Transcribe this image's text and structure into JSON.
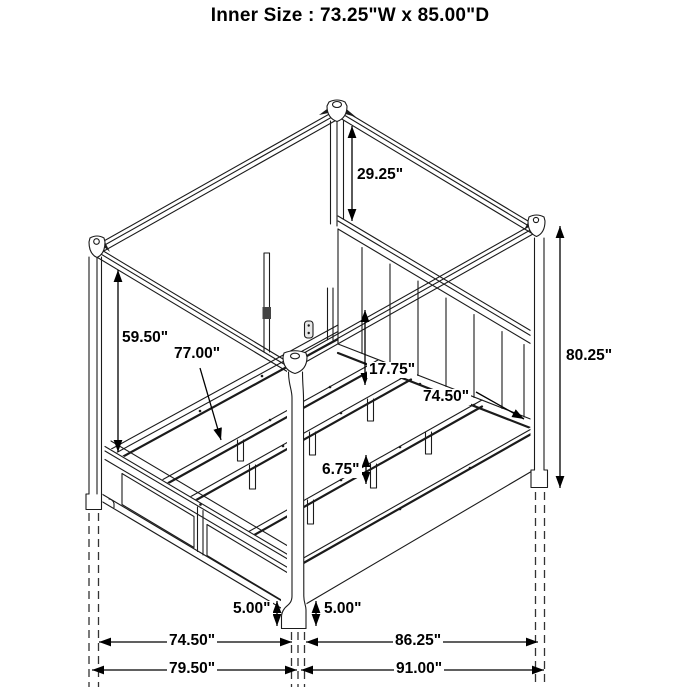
{
  "title": "Inner Size : 73.25\"W x 85.00\"D",
  "diagram": {
    "subject": "canopy-bed-dimension-diagram",
    "line_color": "#1b1b1b",
    "background": "#ffffff"
  },
  "dimensions": {
    "canopy_to_headboard": "29.25\"",
    "footboard_to_canopy": "59.50\"",
    "slat_rail_length": "77.00\"",
    "headboard_to_rail_gap": "17.75\"",
    "inner_rail_width": "74.50\"",
    "post_height": "80.25\"",
    "support_leg_height": "6.75\"",
    "footboard_floor_clearance": "5.00\"",
    "siderail_floor_clearance": "5.00\"",
    "footboard_span": "74.50\"",
    "overall_width": "79.50\"",
    "siderail_span": "86.25\"",
    "overall_depth": "91.00\""
  }
}
